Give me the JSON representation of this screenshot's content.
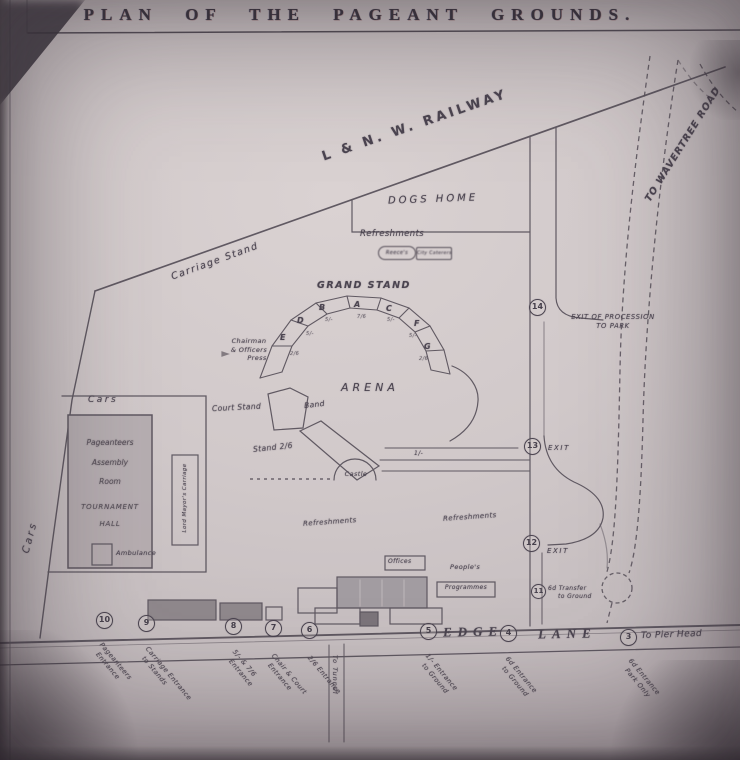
{
  "title": "PLAN OF THE PAGEANT GROUNDS.",
  "roads": {
    "railway": "L & N. W. RAILWAY",
    "wavertree": "TO WAVERTREE ROAD",
    "edge": "EDGE",
    "lane": "LANE",
    "pier_head": "To Pier Head",
    "side_road": "To Tunnel"
  },
  "areas": {
    "carriage_stand": "Carriage Stand",
    "dogs_home": "DOGS HOME",
    "arena": "ARENA",
    "refreshments": "Refreshments",
    "cars": "Cars"
  },
  "kiosks": {
    "left": "Reece's",
    "right": "City Caterers"
  },
  "grandstand": {
    "title": "GRAND STAND",
    "sections": [
      {
        "letter": "E",
        "price": "2/6"
      },
      {
        "letter": "D",
        "price": "5/-"
      },
      {
        "letter": "B",
        "price": "5/-"
      },
      {
        "letter": "A",
        "price": "7/6"
      },
      {
        "letter": "C",
        "price": "5/-"
      },
      {
        "letter": "F",
        "price": "5/-"
      },
      {
        "letter": "G",
        "price": "2/6"
      }
    ]
  },
  "stands": {
    "chairman_1": "Chairman",
    "chairman_2": "& Officers",
    "chairman_3": "Press",
    "court_stand": "Court Stand",
    "band": "Band",
    "stand_26": "Stand 2/6",
    "castle": "Castle",
    "shilling": "1/-"
  },
  "buildings": {
    "assembly_1": "Pageanteers",
    "assembly_2": "Assembly",
    "assembly_3": "Room",
    "assembly_4": "TOURNAMENT",
    "assembly_5": "HALL",
    "ambulance": "Ambulance",
    "lord_mayor": "Lord Mayor's Carriage",
    "offices": "Offices",
    "peoples": "People's",
    "programmes": "Programmes"
  },
  "markers": [
    {
      "n": "14",
      "l1": "EXIT OF PROCESSION",
      "l2": "TO PARK"
    },
    {
      "n": "13",
      "l1": "EXIT",
      "l2": ""
    },
    {
      "n": "12",
      "l1": "EXIT",
      "l2": ""
    },
    {
      "n": "11",
      "l1": "6d Transfer",
      "l2": "to Ground"
    },
    {
      "n": "10",
      "l1": "Pageanteers",
      "l2": "Entrance"
    },
    {
      "n": "9",
      "l1": "Carriage Entrance",
      "l2": "to Stands"
    },
    {
      "n": "8",
      "l1": "5/- & 7/6",
      "l2": "Entrance"
    },
    {
      "n": "7",
      "l1": "Chair & Court",
      "l2": "Entrance"
    },
    {
      "n": "6",
      "l1": "2/6 Entrance",
      "l2": ""
    },
    {
      "n": "5",
      "l1": "1/- Entrance",
      "l2": "to Ground"
    },
    {
      "n": "4",
      "l1": "6d Entrance",
      "l2": "to Ground"
    },
    {
      "n": "3",
      "l1": "6d Entrance",
      "l2": "Park Only"
    }
  ]
}
